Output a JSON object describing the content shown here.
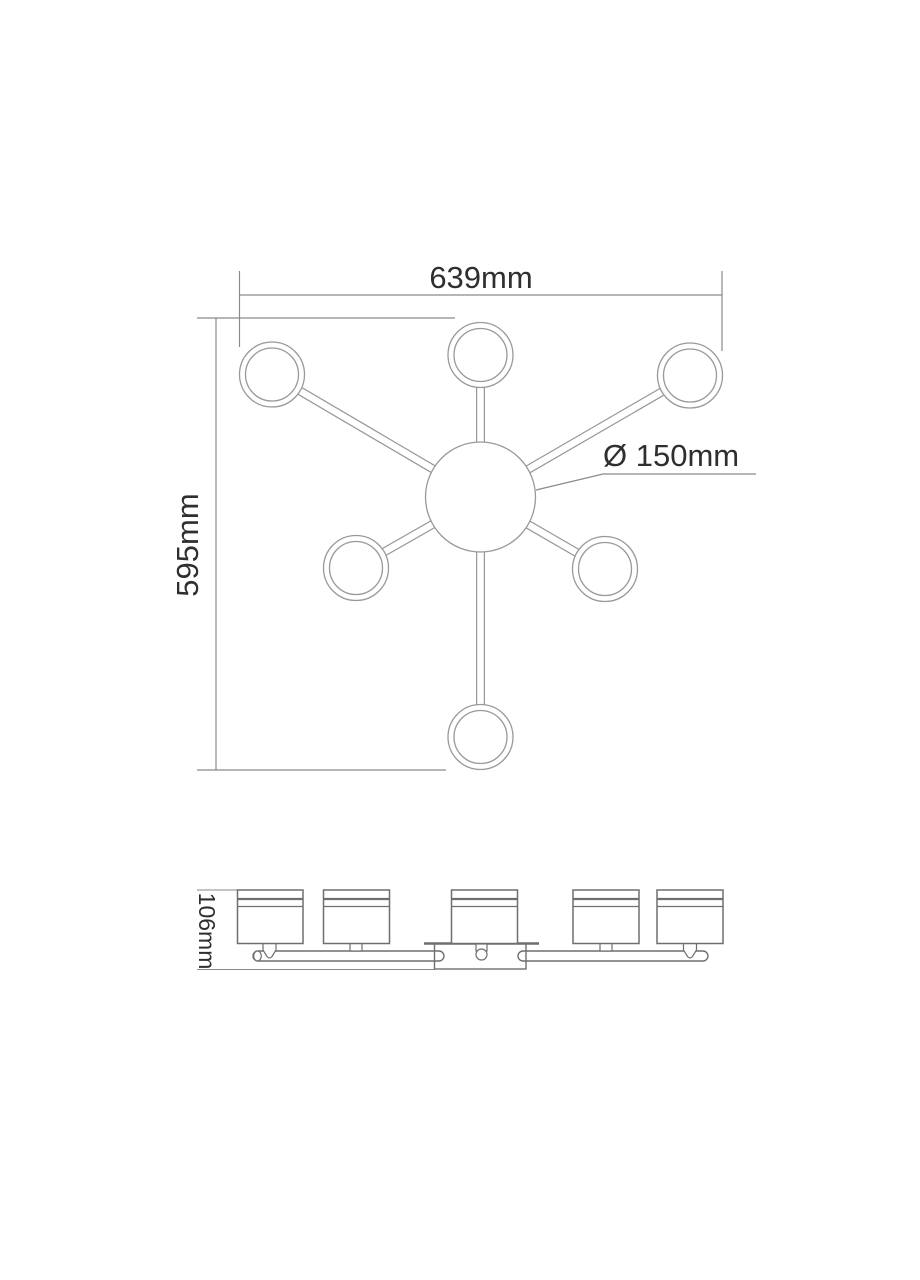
{
  "page": {
    "background": "#ffffff",
    "title": "ceiling-light-dimension-drawing"
  },
  "drawing": {
    "labels": {
      "width": "639mm",
      "height": "595mm",
      "diameter": "Ø 150mm",
      "side_height": "106mm"
    },
    "colors": {
      "fixture_line": "#999999",
      "side_view_line": "#6f6f6f",
      "dimension_line": "#8a8a8a",
      "text": "#2f2f2f",
      "fill": "#ffffff"
    }
  }
}
